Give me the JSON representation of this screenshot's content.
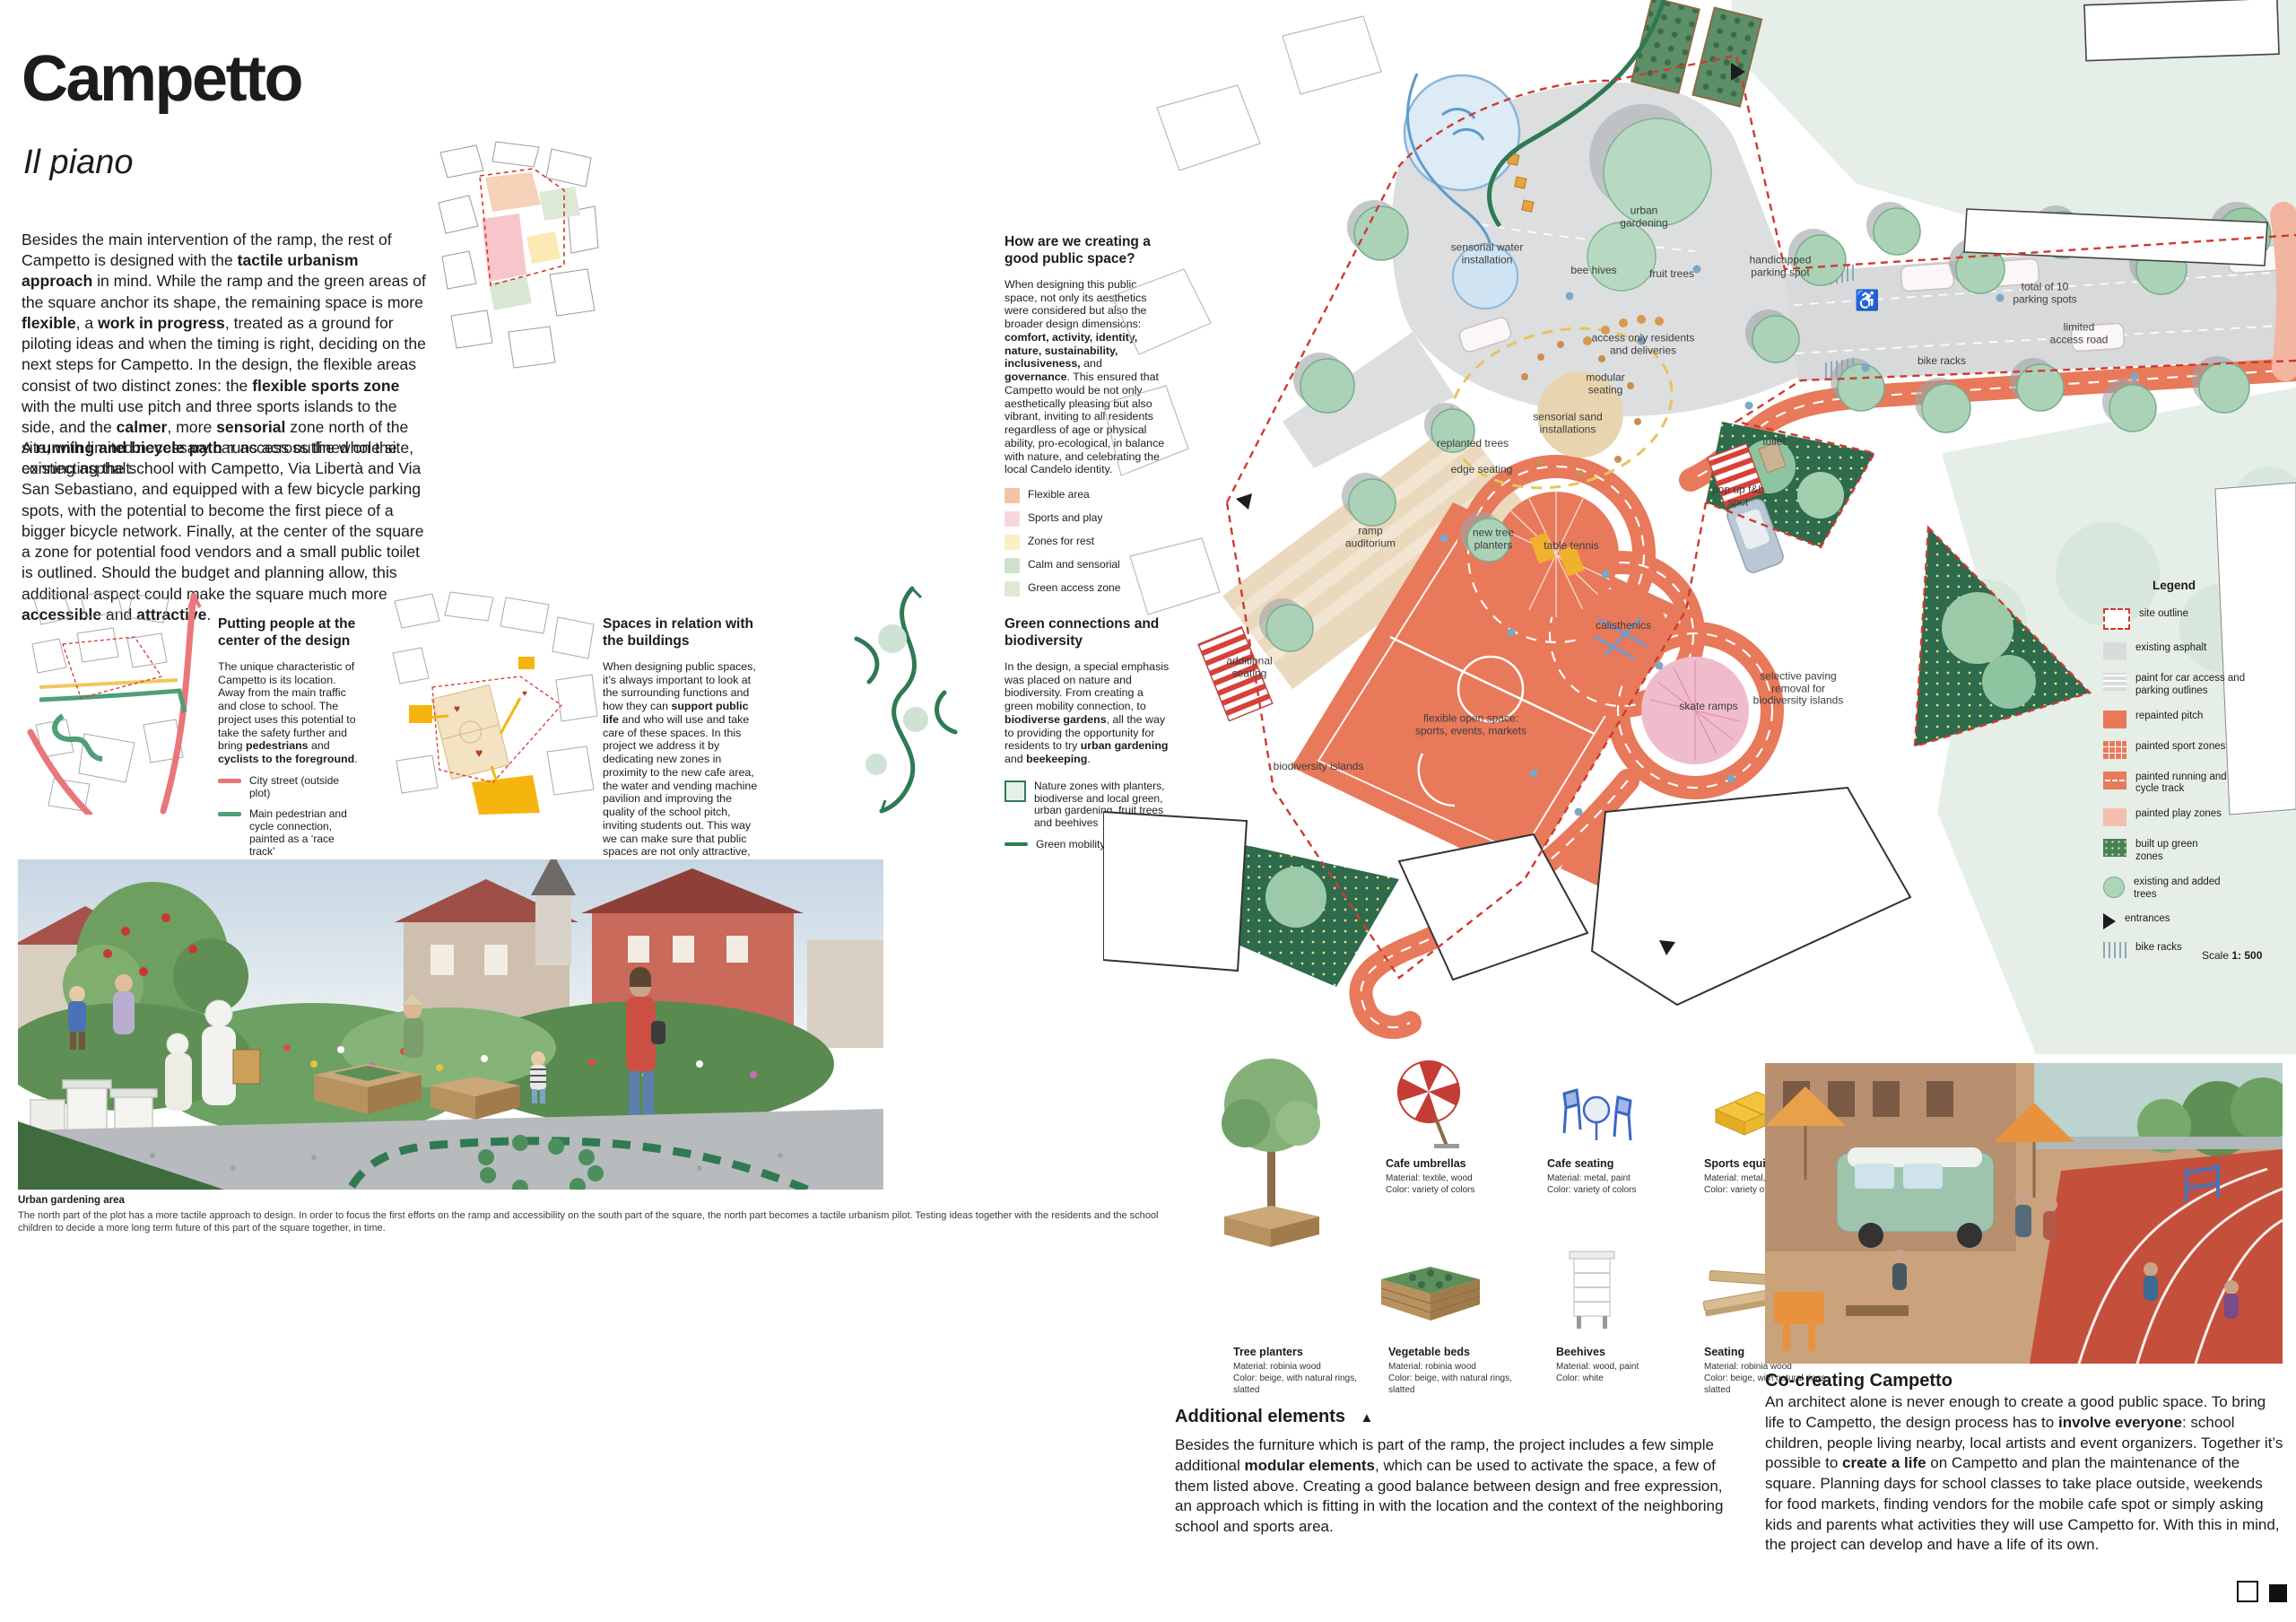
{
  "order": {
    "label": "Order number:",
    "number": "100822"
  },
  "header": {
    "title": "Campetto",
    "subtitle": "Il piano"
  },
  "colors": {
    "track_orange": "#e8795a",
    "play_pink": "#f4c0ae",
    "site_outline_red": "#cf3a30",
    "dark_green": "#2f6b4c",
    "tree_green": "#aed4ba",
    "asphalt_gray": "#d9dbdd",
    "street_red": "#e8767a",
    "path_green": "#4f9e77",
    "priority_yellow": "#f0c75e"
  },
  "intro": {
    "p1": [
      {
        "t": "Besides the main intervention of the ramp, the rest of Campetto is designed with the "
      },
      {
        "t": "tactile urbanism approach",
        "b": true
      },
      {
        "t": " in mind. While the ramp and the green areas of the square anchor its shape, the remaining space is more "
      },
      {
        "t": "flexible",
        "b": true
      },
      {
        "t": ", a "
      },
      {
        "t": "work in progress",
        "b": true
      },
      {
        "t": ", treated as a ground for piloting ideas and when the timing is right, deciding on the next steps for Campetto. In the design, the flexible areas consist of two distinct zones: the "
      },
      {
        "t": "flexible sports zone",
        "b": true
      },
      {
        "t": " with the multi use pitch and three sports islands to the side, and the "
      },
      {
        "t": "calmer",
        "b": true
      },
      {
        "t": ", more "
      },
      {
        "t": "sensorial",
        "b": true
      },
      {
        "t": " zone north of the site, with limited necessary car access outlined on the existing asphalt."
      }
    ],
    "p2": [
      {
        "t": "A "
      },
      {
        "t": "running and bicycle path",
        "b": true
      },
      {
        "t": " runs across the whole site, connecting the school with Campetto, Via Libertà and Via San Sebastiano, and equipped with a few bicycle parking spots, with the potential to become the first piece of a bigger bicycle network. Finally, at the center of the square a zone for potential food vendors and a small public toilet is outlined. Should the budget and planning allow, this additional aspect could make the square much more "
      },
      {
        "t": "accessible",
        "b": true
      },
      {
        "t": " and "
      },
      {
        "t": "attractive",
        "b": true
      },
      {
        "t": "."
      }
    ]
  },
  "public_space": {
    "heading": "How are we creating a good public space?",
    "body": [
      {
        "t": "When designing this public space, not only its aesthetics were considered but also the broader design dimensions: "
      },
      {
        "t": "comfort, activity, identity, nature, sustainability, inclusiveness,",
        "b": true
      },
      {
        "t": " and "
      },
      {
        "t": "governance",
        "b": true
      },
      {
        "t": ". This ensured that Campetto would be not only aesthetically pleasing but also vibrant, inviting to all residents regardless of age or physical ability, pro-ecological, in balance with nature, and celebrating the local Candelo identity."
      }
    ],
    "legend": [
      {
        "label": "Flexible area",
        "color": "#f2c3a6"
      },
      {
        "label": "Sports and play",
        "color": "#f8d7dc"
      },
      {
        "label": "Zones for rest",
        "color": "#fcefc8"
      },
      {
        "label": "Calm and sensorial",
        "color": "#cfe0cd"
      },
      {
        "label": "Green access zone",
        "color": "#dde9d5"
      }
    ]
  },
  "columns": [
    {
      "heading": "Putting people at the center of the design",
      "body": [
        {
          "t": "The unique characteristic of Campetto is its location. Away from the main traffic and close to school. The project uses this potential to take the safety further and bring "
        },
        {
          "t": "pedestrians",
          "b": true
        },
        {
          "t": " and "
        },
        {
          "t": "cyclists to the foreground",
          "b": true
        },
        {
          "t": "."
        }
      ],
      "legend": [
        {
          "label": "City street (outside plot)"
        },
        {
          "label": "Main pedestrian and cycle connection, painted as a ‘race track’"
        },
        {
          "label": "Pedestrian priority, no through traffic"
        },
        {
          "label": "Pedestrian priority, access street"
        }
      ]
    },
    {
      "heading": "Spaces in relation with the buildings",
      "body": [
        {
          "t": "When designing public spaces, it’s always important to look at the surrounding functions and how they can "
        },
        {
          "t": "support public life",
          "b": true
        },
        {
          "t": " and who will use and take care of these spaces. In this project we address it by dedicating new zones in proximity to the new cafe area, the water and vending machine pavilion and improving the quality of the school pitch, inviting students out. This way we can make sure that public spaces are not only attractive, but above all "
        },
        {
          "t": "vibrant",
          "b": true
        },
        {
          "t": " and "
        },
        {
          "t": "active",
          "b": true
        },
        {
          "t": "."
        }
      ]
    },
    {
      "heading": "Green connections and biodiversity",
      "body": [
        {
          "t": "In the design, a special emphasis was placed on nature and biodiversity. From creating a green mobility connection, to "
        },
        {
          "t": "biodiverse gardens",
          "b": true
        },
        {
          "t": ", all the way to providing the opportunity for residents to try "
        },
        {
          "t": "urban gardening",
          "b": true
        },
        {
          "t": " and "
        },
        {
          "t": "beekeeping",
          "b": true
        },
        {
          "t": "."
        }
      ],
      "legend": [
        {
          "label": "Nature zones with planters, biodiverse and local green, urban gardening, fruit trees and beehives"
        },
        {
          "label": "Green mobility connection"
        }
      ]
    }
  ],
  "site_plan": {
    "labels": [
      {
        "text": "sensorial water\ninstallation"
      },
      {
        "text": "urban\ngardening"
      },
      {
        "text": "bee hives"
      },
      {
        "text": "fruit trees"
      },
      {
        "text": "handicapped\nparking spot"
      },
      {
        "text": "access only residents\nand deliveries"
      },
      {
        "text": "modular\nseating"
      },
      {
        "text": "sensorial sand\ninstallations"
      },
      {
        "text": "replanted trees"
      },
      {
        "text": "edge seating"
      },
      {
        "text": "total of 10\nparking spots"
      },
      {
        "text": "limited\naccess road"
      },
      {
        "text": "bike racks"
      },
      {
        "text": "toilet"
      },
      {
        "text": "pop up f&b\nspot"
      },
      {
        "text": "ramp\nauditorium"
      },
      {
        "text": "new tree\nplanters"
      },
      {
        "text": "table tennis"
      },
      {
        "text": "calisthenics"
      },
      {
        "text": "skate ramps"
      },
      {
        "text": "selective paving\nremoval for\nbiodiversity islands"
      },
      {
        "text": "additional\nseating"
      },
      {
        "text": "flexible open space:\nsports, events, markets"
      },
      {
        "text": "biodiversity islands"
      }
    ],
    "legend": {
      "title": "Legend",
      "items": [
        {
          "label": "site outline"
        },
        {
          "label": "existing asphalt"
        },
        {
          "label": "paint for car access and parking outlines"
        },
        {
          "label": "repainted pitch"
        },
        {
          "label": "painted sport zones"
        },
        {
          "label": "painted running and cycle track"
        },
        {
          "label": "painted play zones"
        },
        {
          "label": "built up green zones"
        },
        {
          "label": "existing and added trees"
        },
        {
          "label": "entrances"
        },
        {
          "label": "bike racks"
        }
      ],
      "scale_label": "Scale",
      "scale_value": "1: 500"
    }
  },
  "photo_caption": {
    "title": "Urban gardening area",
    "text": "The north part of the plot has a more tactile approach to design. In order to focus the first efforts on the ramp and accessibility on the south part of the square, the north part becomes a tactile urbanism pilot. Testing ideas together with the residents and the school children to decide a more long term future of this part of the square together, in time."
  },
  "furniture": {
    "items": [
      {
        "name": "Cafe umbrellas",
        "material": "Material: textile, wood",
        "color": "Color: variety of colors"
      },
      {
        "name": "Cafe seating",
        "material": "Material: metal, paint",
        "color": "Color: variety of colors"
      },
      {
        "name": "Sports equipment",
        "material": "Material: metal, wood",
        "color": "Color: variety of colors"
      },
      {
        "name": "Tree planters",
        "material": "Material: robinia wood",
        "color": "Color: beige, with natural rings, slatted"
      },
      {
        "name": "Vegetable beds",
        "material": "Material: robinia wood",
        "color": "Color: beige, with natural rings, slatted"
      },
      {
        "name": "Beehives",
        "material": "Material: wood, paint",
        "color": "Color: white"
      },
      {
        "name": "Seating",
        "material": "Material: robinia wood",
        "color": "Color: beige, with natural rings, slatted"
      }
    ]
  },
  "additional": {
    "heading": "Additional elements",
    "marker": "▲",
    "body": [
      {
        "t": "Besides the furniture which is part of the ramp, the project includes a few simple additional "
      },
      {
        "t": "modular elements",
        "b": true
      },
      {
        "t": ", which can be used to activate the space, a few of them listed above. Creating a good balance between design and free expression, an approach which is fitting in with the location and the context of the neighboring school and sports area."
      }
    ]
  },
  "cocreating": {
    "heading": "Co-creating Campetto",
    "body": [
      {
        "t": "An architect alone is never enough to create a good public space. To bring life to Campetto, the design process has to "
      },
      {
        "t": "involve everyone",
        "b": true
      },
      {
        "t": ": school children, people living nearby, local artists and event organizers. Together it’s possible to "
      },
      {
        "t": "create a life",
        "b": true
      },
      {
        "t": " on Campetto and plan the maintenance of the square. Planning days for school classes to take place outside, weekends for food markets, finding vendors for the mobile cafe spot or simply asking kids and parents what activities they will use Campetto for. With this in mind, the project can develop and have a life of its own."
      }
    ]
  }
}
